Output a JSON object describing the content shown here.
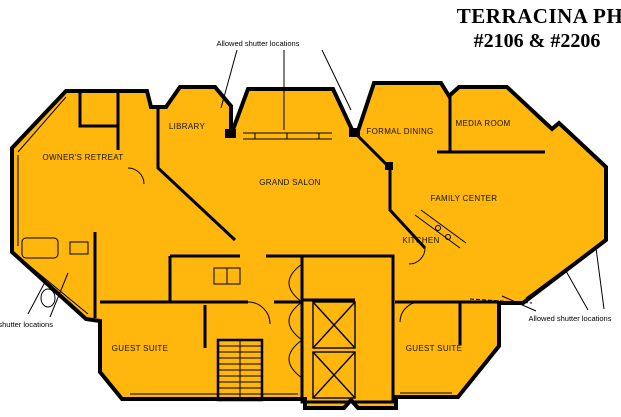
{
  "title": {
    "line1": "TERRACINA PH",
    "line2": "#2106 & #2206"
  },
  "annotations": {
    "top": "Allowed shutter locations",
    "bottom_left": "Allowed shutter locations",
    "bottom_right": "Allowed shutter locations"
  },
  "rooms": {
    "owners_retreat": "OWNER'S RETREAT",
    "library": "LIBRARY",
    "grand_salon": "GRAND SALON",
    "formal_dining": "FORMAL DINING",
    "media_room": "MEDIA ROOM",
    "family_center": "FAMILY CENTER",
    "kitchen": "KITCHEN",
    "guest_suite_left": "GUEST SUITE",
    "guest_suite_right": "GUEST SUITE"
  },
  "colors": {
    "plan_fill": "#FFB60D",
    "wall": "#000000",
    "background": "#FFFFFF"
  }
}
